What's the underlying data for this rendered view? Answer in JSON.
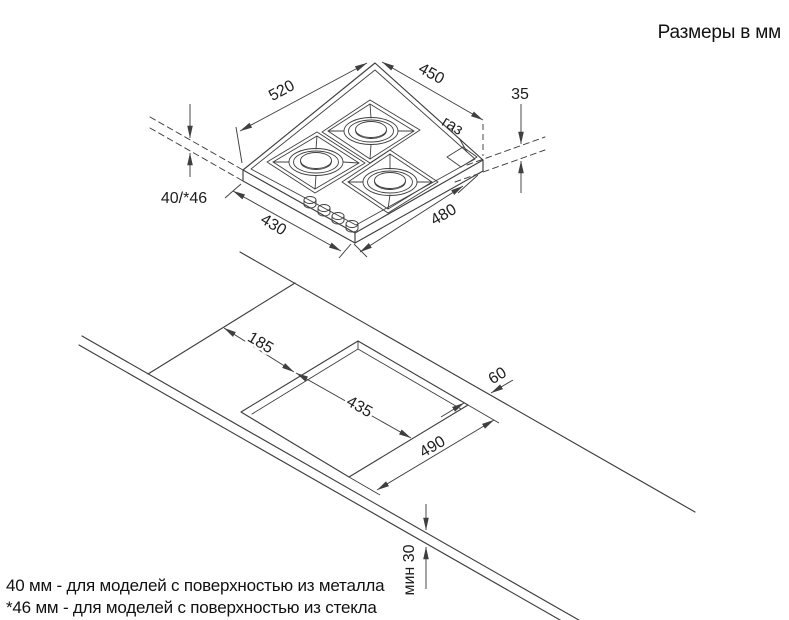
{
  "title": "Размеры в мм",
  "hob": {
    "width_top": "520",
    "depth_top": "450",
    "gas_offset": "35",
    "gas_label": "газ",
    "height": "40/*46",
    "depth_bottom": "430",
    "width_bottom": "480"
  },
  "cutout": {
    "side_offset": "185",
    "width": "435",
    "back_gap": "60",
    "depth": "490",
    "min_thickness": "мин 30"
  },
  "footnotes": [
    "40 мм - для моделей с поверхностью из металла",
    "*46 мм - для моделей с поверхностью из стекла"
  ],
  "colors": {
    "line": "#3f3f3f",
    "text": "#1e1e1e"
  }
}
